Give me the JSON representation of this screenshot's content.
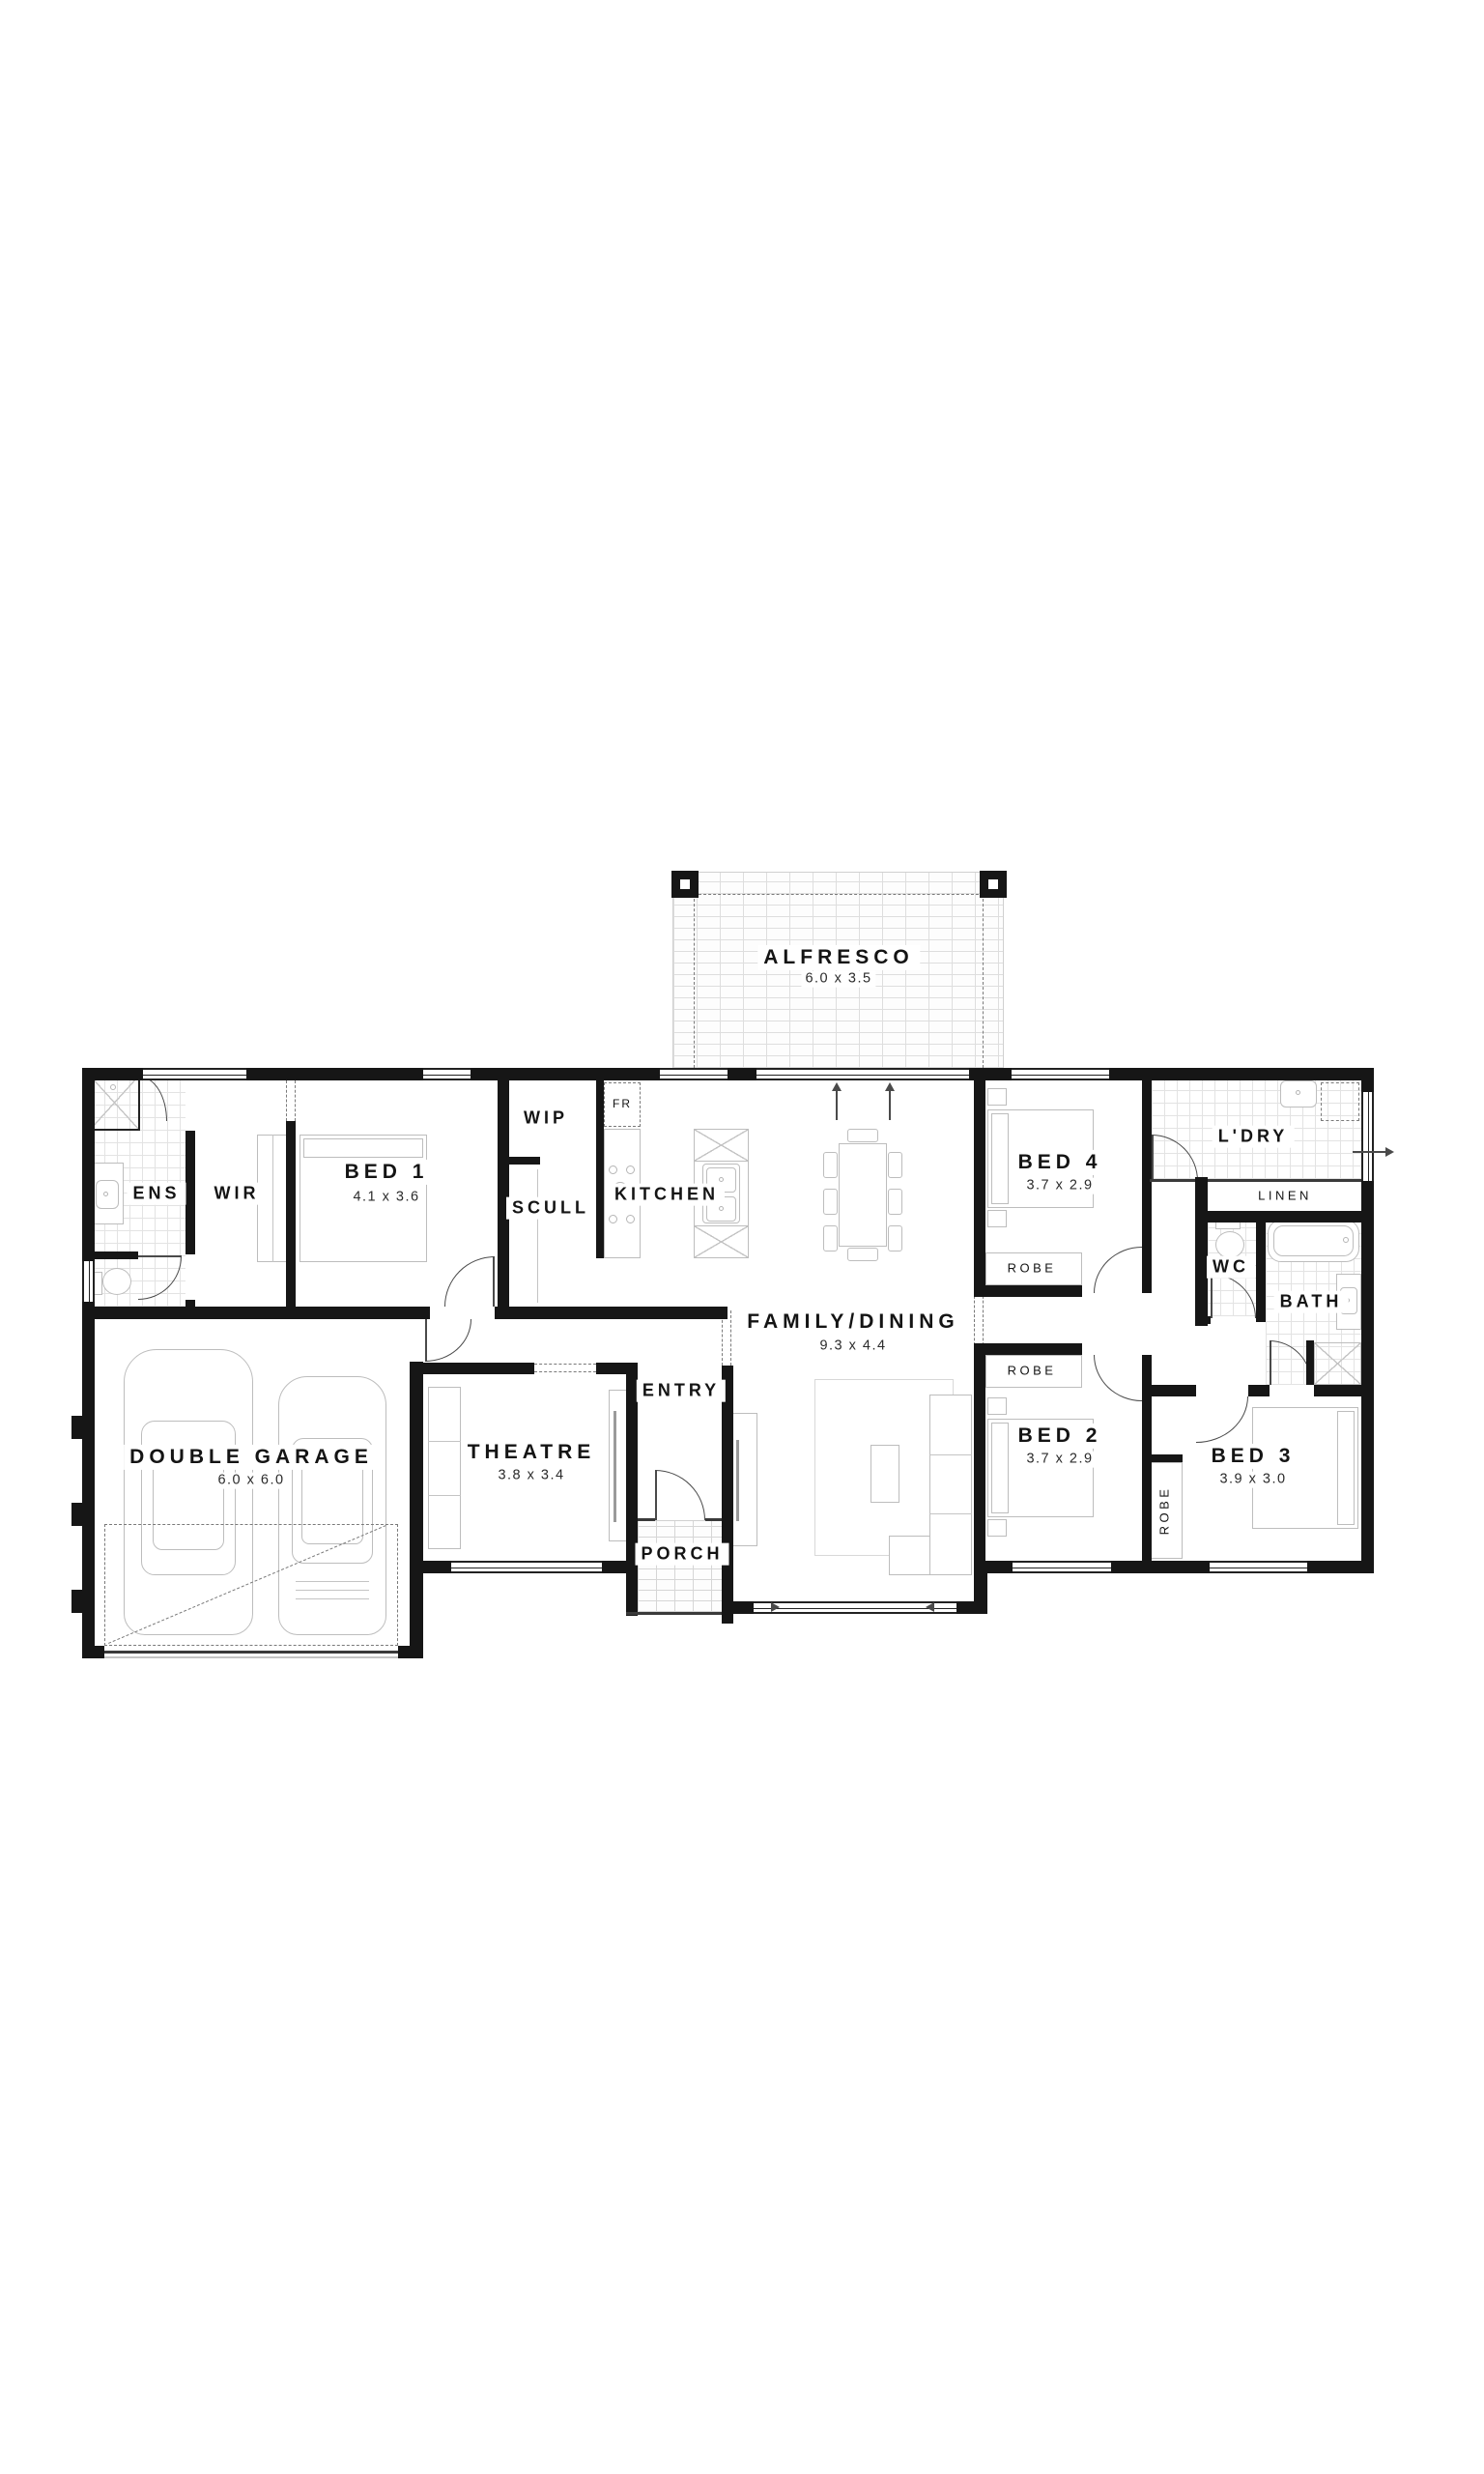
{
  "plan": {
    "background": "#ffffff",
    "wall_color": "#161616",
    "rooms": {
      "alfresco": {
        "label": "ALFRESCO",
        "dim": "6.0 x 3.5"
      },
      "ens": {
        "label": "ENS"
      },
      "wir": {
        "label": "WIR"
      },
      "bed1": {
        "label": "BED 1",
        "dim": "4.1 x 3.6"
      },
      "wip": {
        "label": "WIP"
      },
      "scull": {
        "label": "SCULL"
      },
      "kitchen": {
        "label": "KITCHEN"
      },
      "fridge": {
        "label": "FR"
      },
      "family": {
        "label": "FAMILY/DINING",
        "dim": "9.3 x 4.4"
      },
      "bed4": {
        "label": "BED 4",
        "dim": "3.7 x 2.9"
      },
      "robe_bed4": {
        "label": "ROBE"
      },
      "ldry": {
        "label": "L'DRY"
      },
      "linen": {
        "label": "LINEN"
      },
      "wc": {
        "label": "WC"
      },
      "bath": {
        "label": "BATH"
      },
      "robe_bed2": {
        "label": "ROBE"
      },
      "bed2": {
        "label": "BED 2",
        "dim": "3.7 x 2.9"
      },
      "robe_bed3": {
        "label": "ROBE"
      },
      "bed3": {
        "label": "BED 3",
        "dim": "3.9 x 3.0"
      },
      "garage": {
        "label": "DOUBLE GARAGE",
        "dim": "6.0 x 6.0"
      },
      "theatre": {
        "label": "THEATRE",
        "dim": "3.8 x 3.4"
      },
      "entry": {
        "label": "ENTRY"
      },
      "porch": {
        "label": "PORCH"
      }
    }
  }
}
